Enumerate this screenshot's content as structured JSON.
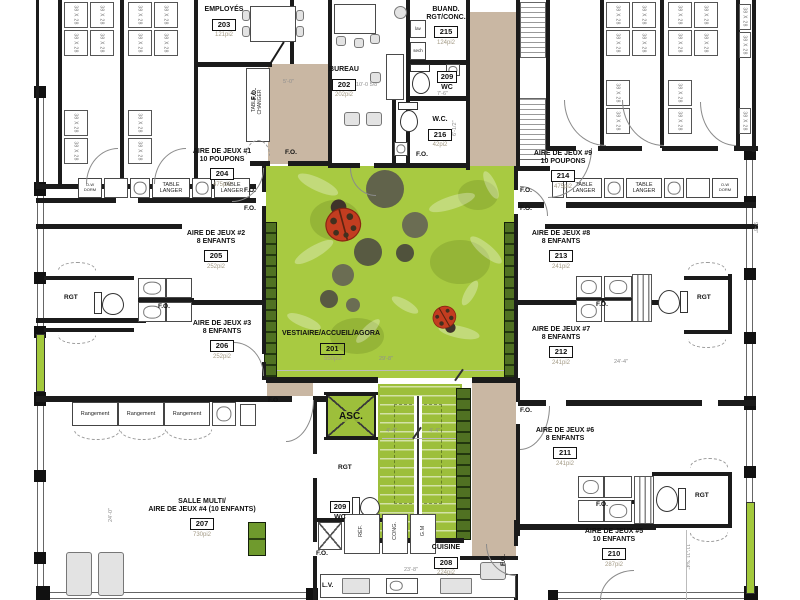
{
  "rooms": {
    "agora": {
      "name": "VESTIAIRE/ACCUEIL/AGORA",
      "num": "201",
      "area": "550pi2"
    },
    "bureau": {
      "name": "BUREAU",
      "num": "202",
      "area": "202pi2"
    },
    "employes": {
      "name": "EMPLOYÉS",
      "num": "203",
      "area": "121pi2"
    },
    "jeux1": {
      "name": "AIRE DE JEUX #1\n10 POUPONS",
      "num": "204",
      "area": "475pi2"
    },
    "jeux2": {
      "name": "AIRE DE JEUX #2\n8 ENFANTS",
      "num": "205",
      "area": "252pi2"
    },
    "jeux3": {
      "name": "AIRE DE JEUX #3\n8 ENFANTS",
      "num": "206",
      "area": "252pi2"
    },
    "salle_multi": {
      "name": "SALLE MULTI/\nAIRE DE JEUX #4 (10 ENFANTS)",
      "num": "207",
      "area": "730pi2"
    },
    "cuisine": {
      "name": "CUISINE",
      "num": "208",
      "area": "224pi2"
    },
    "wc209_haut": {
      "num": "209",
      "name": "WC"
    },
    "wc209_bas": {
      "num": "209",
      "name": "WC"
    },
    "jeux5": {
      "name": "AIRE DE JEUX #5\n10 ENFANTS",
      "num": "210",
      "area": "287pi2"
    },
    "jeux6": {
      "name": "AIRE DE JEUX #6\n8 ENFANTS",
      "num": "211",
      "area": "241pi2"
    },
    "jeux7": {
      "name": "AIRE DE JEUX #7\n8 ENFANTS",
      "num": "212",
      "area": "241pi2"
    },
    "jeux8": {
      "name": "AIRE DE JEUX #8\n8 ENFANTS",
      "num": "213",
      "area": "241pi2"
    },
    "jeux9": {
      "name": "AIRE DE JEUX #9\n10 POUPONS",
      "num": "214",
      "area": "475pi2"
    },
    "buanderie": {
      "name": "BUAND.\nRGT/CONC.",
      "num": "215",
      "area": "124pi2"
    },
    "wc216": {
      "name": "W.C.",
      "num": "216",
      "area": "42pi2"
    },
    "ascenseur": {
      "name": "ASC."
    }
  },
  "labels": {
    "fo": "F.O.",
    "rgt": "RGT",
    "rangement": "Rangement",
    "table_langer": "TABLE\nLANGER",
    "table_a_changer": "TABLE À\nCHANGER",
    "crib": "38 X 28",
    "dw": "O-W\nDORM",
    "lav": "lav",
    "sech": "sech",
    "ref": "RÉF.",
    "cong": "CONG.",
    "gm": "G.M",
    "lv": "L.V."
  },
  "dimensions": {
    "d1": "5'-0\"",
    "d2": "10'-0 5/8\"",
    "d3": "7'-6\"",
    "d4": "29'-8\"",
    "d5": "24'-4\"",
    "d6": "23'-8\"",
    "d7": "11'-11 3/4\"",
    "d8": "4'-4\"",
    "d9": "9'-8\"",
    "d10": "6'-1/2\"",
    "d11": "24'-0\""
  },
  "colors": {
    "agora_green": "#a8ca41",
    "stair_green": "#9dbf3b",
    "locker_green": "#3f5c19",
    "corridor_beige": "#c9b7a3",
    "ladybug_red": "#c33d20",
    "wall_black": "#1b1b1b"
  }
}
